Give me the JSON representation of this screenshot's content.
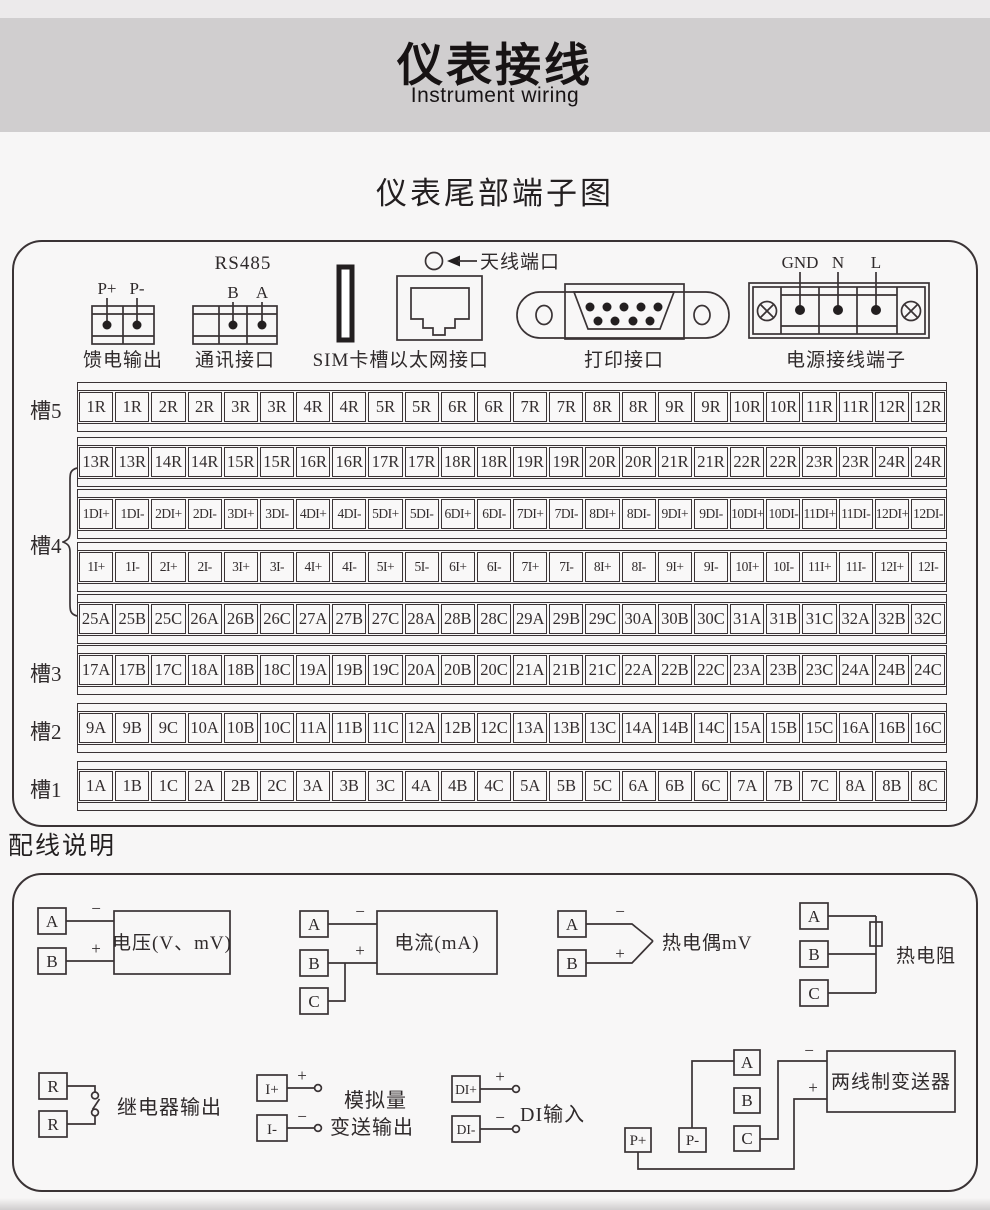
{
  "header": {
    "title": "仪表接线",
    "subtitle": "Instrument wiring"
  },
  "section1": {
    "heading": "仪表尾部端子图"
  },
  "connectors": {
    "feed": {
      "label": "馈电输出",
      "pins": [
        "P+",
        "P-"
      ]
    },
    "comm": {
      "label": "通讯接口",
      "protocol": "RS485",
      "pins": [
        "B",
        "A"
      ]
    },
    "sim": {
      "label": "SIM卡槽"
    },
    "ethernet": {
      "label": "以太网接口"
    },
    "antenna": {
      "label": "天线端口"
    },
    "printer": {
      "label": "打印接口"
    },
    "power": {
      "label": "电源接线端子",
      "pins": [
        "GND",
        "N",
        "L"
      ]
    }
  },
  "slots": {
    "slot5_label": "槽5",
    "slot4_label": "槽4",
    "slot3_label": "槽3",
    "slot2_label": "槽2",
    "slot1_label": "槽1",
    "rows": [
      {
        "name": "slot5-relay",
        "cells": [
          "1R",
          "1R",
          "2R",
          "2R",
          "3R",
          "3R",
          "4R",
          "4R",
          "5R",
          "5R",
          "6R",
          "6R",
          "7R",
          "7R",
          "8R",
          "8R",
          "9R",
          "9R",
          "10R",
          "10R",
          "11R",
          "11R",
          "12R",
          "12R"
        ]
      },
      {
        "name": "slot4-relay",
        "cells": [
          "13R",
          "13R",
          "14R",
          "14R",
          "15R",
          "15R",
          "16R",
          "16R",
          "17R",
          "17R",
          "18R",
          "18R",
          "19R",
          "19R",
          "20R",
          "20R",
          "21R",
          "21R",
          "22R",
          "22R",
          "23R",
          "23R",
          "24R",
          "24R"
        ]
      },
      {
        "name": "slot4-di",
        "cells": [
          "1DI+",
          "1DI-",
          "2DI+",
          "2DI-",
          "3DI+",
          "3DI-",
          "4DI+",
          "4DI-",
          "5DI+",
          "5DI-",
          "6DI+",
          "6DI-",
          "7DI+",
          "7DI-",
          "8DI+",
          "8DI-",
          "9DI+",
          "9DI-",
          "10DI+",
          "10DI-",
          "11DI+",
          "11DI-",
          "12DI+",
          "12DI-"
        ]
      },
      {
        "name": "slot4-i",
        "cells": [
          "1I+",
          "1I-",
          "2I+",
          "2I-",
          "3I+",
          "3I-",
          "4I+",
          "4I-",
          "5I+",
          "5I-",
          "6I+",
          "6I-",
          "7I+",
          "7I-",
          "8I+",
          "8I-",
          "9I+",
          "9I-",
          "10I+",
          "10I-",
          "11I+",
          "11I-",
          "12I+",
          "12I-"
        ]
      },
      {
        "name": "slot4-abc",
        "cells": [
          "25A",
          "25B",
          "25C",
          "26A",
          "26B",
          "26C",
          "27A",
          "27B",
          "27C",
          "28A",
          "28B",
          "28C",
          "29A",
          "29B",
          "29C",
          "30A",
          "30B",
          "30C",
          "31A",
          "31B",
          "31C",
          "32A",
          "32B",
          "32C"
        ]
      },
      {
        "name": "slot3",
        "cells": [
          "17A",
          "17B",
          "17C",
          "18A",
          "18B",
          "18C",
          "19A",
          "19B",
          "19C",
          "20A",
          "20B",
          "20C",
          "21A",
          "21B",
          "21C",
          "22A",
          "22B",
          "22C",
          "23A",
          "23B",
          "23C",
          "24A",
          "24B",
          "24C"
        ]
      },
      {
        "name": "slot2",
        "cells": [
          "9A",
          "9B",
          "9C",
          "10A",
          "10B",
          "10C",
          "11A",
          "11B",
          "11C",
          "12A",
          "12B",
          "12C",
          "13A",
          "13B",
          "13C",
          "14A",
          "14B",
          "14C",
          "15A",
          "15B",
          "15C",
          "16A",
          "16B",
          "16C"
        ]
      },
      {
        "name": "slot1",
        "cells": [
          "1A",
          "1B",
          "1C",
          "2A",
          "2B",
          "2C",
          "3A",
          "3B",
          "3C",
          "4A",
          "4B",
          "4C",
          "5A",
          "5B",
          "5C",
          "6A",
          "6B",
          "6C",
          "7A",
          "7B",
          "7C",
          "8A",
          "8B",
          "8C"
        ]
      }
    ]
  },
  "wiring": {
    "heading": "配线说明",
    "voltage": {
      "terminals": [
        "A",
        "B"
      ],
      "minus": "−",
      "plus": "+",
      "label": "电压(V、mV)"
    },
    "current": {
      "terminals": [
        "A",
        "B",
        "C"
      ],
      "minus": "−",
      "plus": "+",
      "label": "电流(mA)"
    },
    "thermocouple": {
      "terminals": [
        "A",
        "B"
      ],
      "minus": "−",
      "plus": "+",
      "label": "热电偶mV"
    },
    "rtd": {
      "terminals": [
        "A",
        "B",
        "C"
      ],
      "label": "热电阻"
    },
    "relay": {
      "terminals": [
        "R",
        "R"
      ],
      "label": "继电器输出"
    },
    "analog": {
      "terminals": [
        "I+",
        "I-"
      ],
      "minus": "−",
      "plus": "+",
      "label1": "模拟量",
      "label2": "变送输出"
    },
    "di": {
      "terminals": [
        "DI+",
        "DI-"
      ],
      "minus": "−",
      "plus": "+",
      "label": "DI输入"
    },
    "transmitter": {
      "terminals": [
        "A",
        "B",
        "C"
      ],
      "power": [
        "P+",
        "P-"
      ],
      "minus": "−",
      "plus": "+",
      "label": "两线制变送器"
    }
  },
  "colors": {
    "line": "#3a3335",
    "band": "#d0cecf",
    "background": "#f7f6f6"
  }
}
